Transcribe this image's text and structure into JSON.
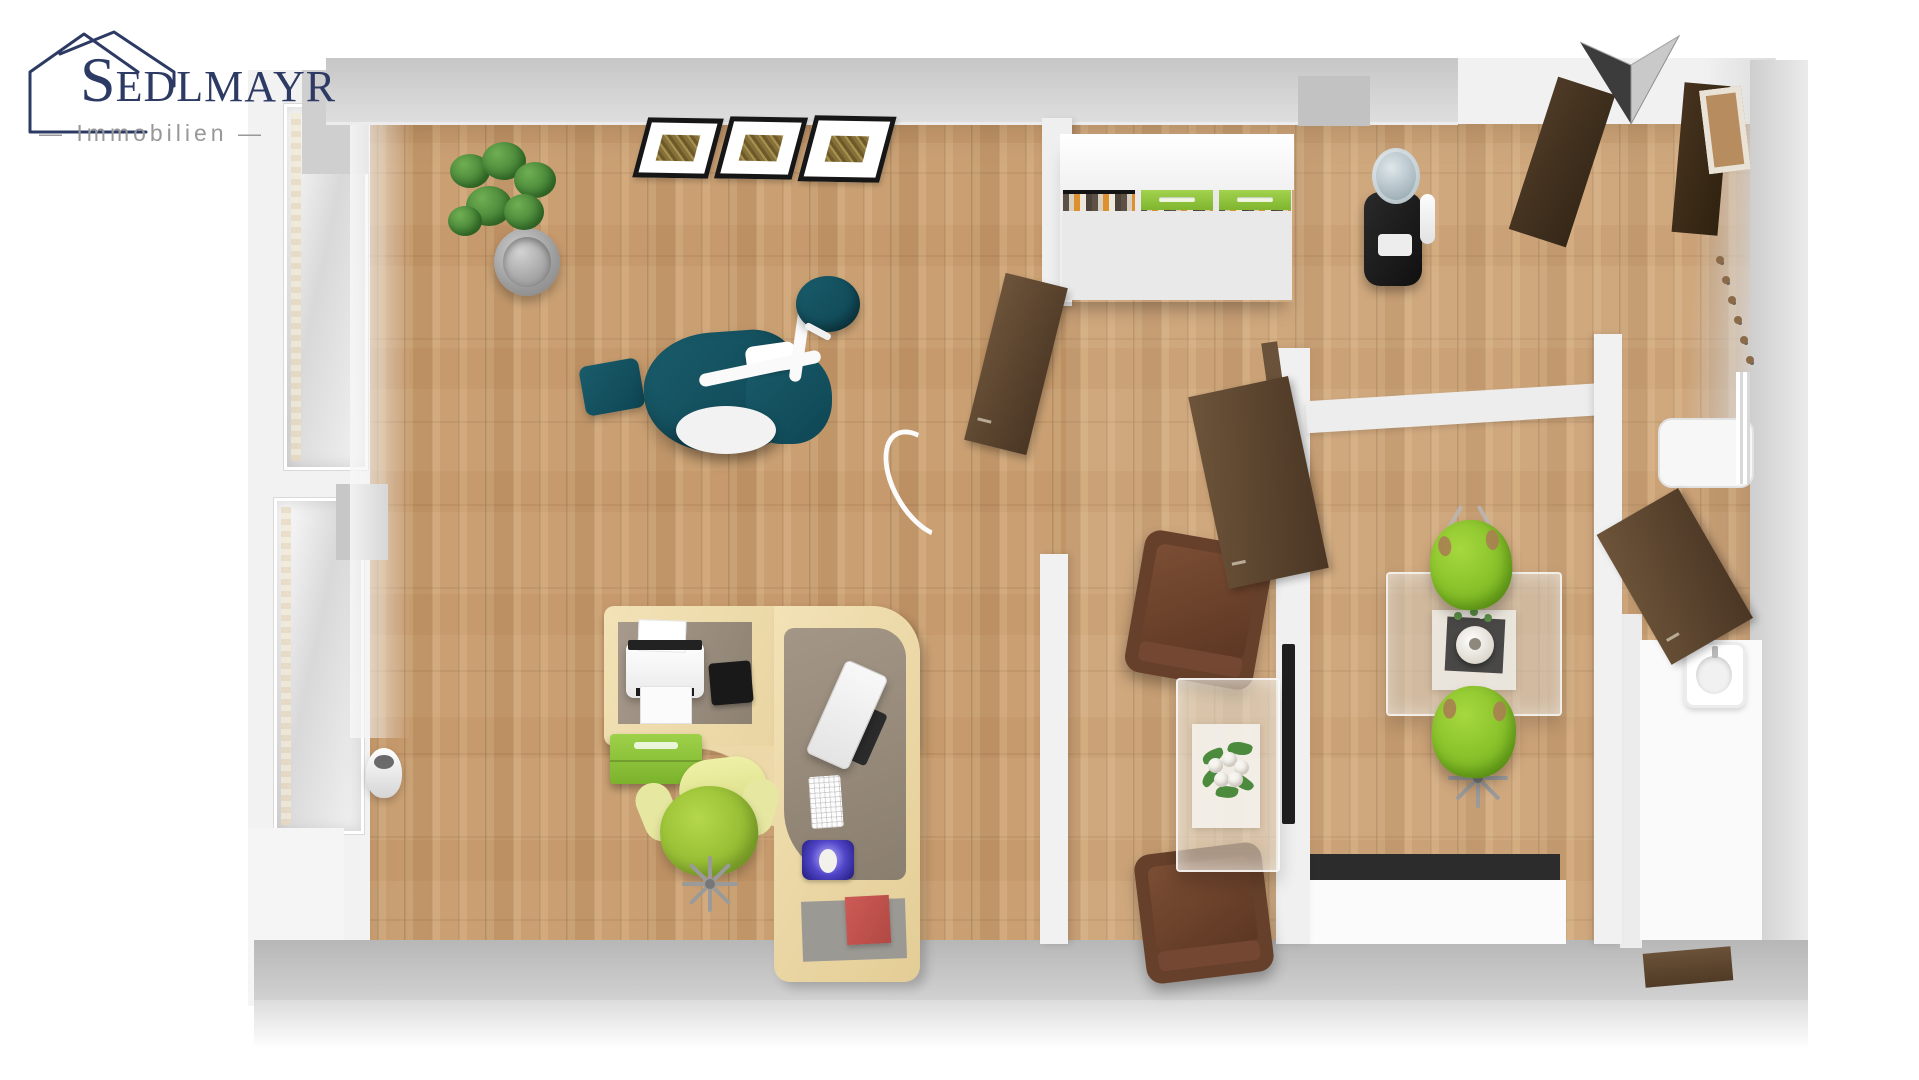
{
  "logo": {
    "brand_initial": "S",
    "brand_rest": "EDLMAYR",
    "tagline": "— Immobilien —",
    "brand_color": "#2c3a64",
    "tagline_color": "#989898"
  },
  "icons": {
    "logo_house": "house-outline-icon",
    "north_arrow": "north-arrow-icon pointing down, split dark/light"
  },
  "palette": {
    "wall_gray": "#cccccc",
    "floor_wood": "#c69a6c",
    "dental_chair_teal": "#14525f",
    "lime_green": "#8dc63f",
    "door_brown": "#55402b",
    "armchair_brown": "#66402a",
    "desk_beech": "#eedcae",
    "book_red": "#c1504d",
    "mousepad_purple": "#4a3cc0",
    "counter_black": "#2c2c2c"
  },
  "floorplan": {
    "type": "3d-top-down-floor-plan-rendering",
    "rooms": [
      {
        "id": "treatment-room",
        "contents": [
          "dental chair with instrument arm",
          "round teal stool",
          "three wall pictures",
          "potted plant",
          "L-shaped corner desk",
          "printer",
          "monitor",
          "keyboard",
          "mousepad with mouse",
          "black tablet",
          "green drawer unit",
          "red book",
          "green office chair",
          "waste bin",
          "window wall with curtains"
        ]
      },
      {
        "id": "waiting-area",
        "contents": [
          "filing shelf with binders and green drawers",
          "water cooler",
          "two brown armchairs",
          "glass coffee table with white flower bouquet",
          "black wall panel",
          "open door"
        ]
      },
      {
        "id": "meeting-room",
        "contents": [
          "glass table",
          "white vase on dark tray",
          "two lime-green shell chairs",
          "open door"
        ]
      },
      {
        "id": "hallway",
        "contents": [
          "entrance doors dark brown",
          "wooden door frame",
          "coat hooks",
          "white cabinet"
        ]
      },
      {
        "id": "washroom",
        "contents": [
          "washbasin with faucet",
          "door"
        ]
      }
    ]
  }
}
